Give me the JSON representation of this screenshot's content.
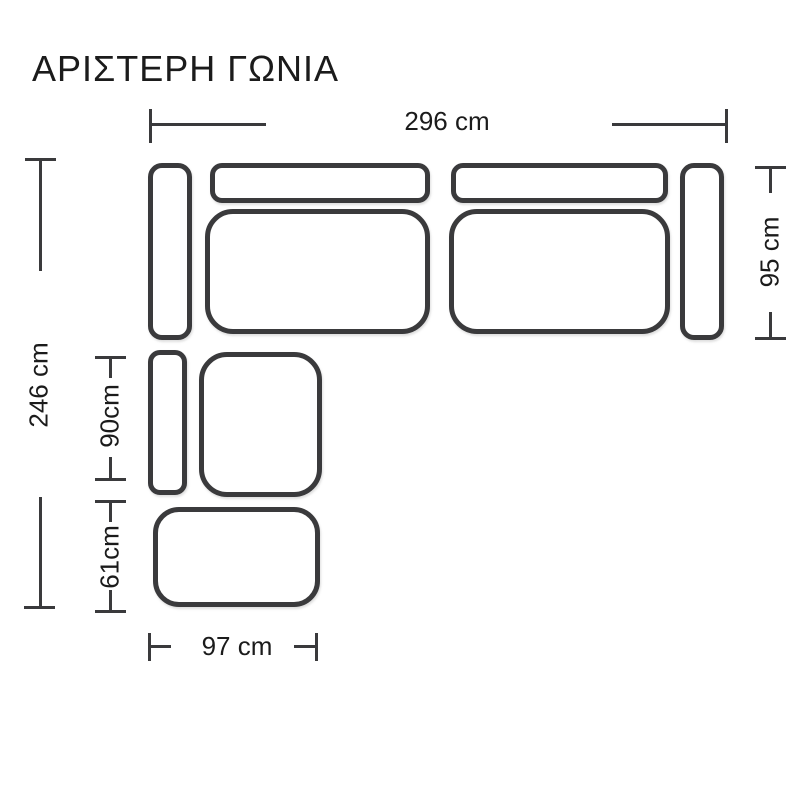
{
  "title": "ΑΡΙΣΤΕΡΗ ΓΩΝΙΑ",
  "colors": {
    "line": "#3a3a3c",
    "text": "#1b1b1b",
    "background": "#ffffff"
  },
  "diagram": {
    "type": "sofa-floorplan",
    "description_visible_parts": [
      "left-armrest",
      "backrest-left",
      "backrest-right",
      "seat-left",
      "seat-right",
      "right-armrest",
      "corner-armrest",
      "corner-seat",
      "ottoman"
    ],
    "dims": {
      "total_width": {
        "label": "296 cm",
        "value_cm": 296,
        "axis": "horizontal",
        "position": "top"
      },
      "depth_right": {
        "label": "95 cm",
        "value_cm": 95,
        "axis": "vertical",
        "position": "right"
      },
      "total_depth": {
        "label": "246 cm",
        "value_cm": 246,
        "axis": "vertical",
        "position": "left"
      },
      "corner_depth": {
        "label": "90cm",
        "value_cm": 90,
        "axis": "vertical",
        "position": "inner-left"
      },
      "ottoman_depth": {
        "label": "61cm",
        "value_cm": 61,
        "axis": "vertical",
        "position": "inner-left"
      },
      "ottoman_width": {
        "label": "97 cm",
        "value_cm": 97,
        "axis": "horizontal",
        "position": "bottom"
      }
    }
  }
}
